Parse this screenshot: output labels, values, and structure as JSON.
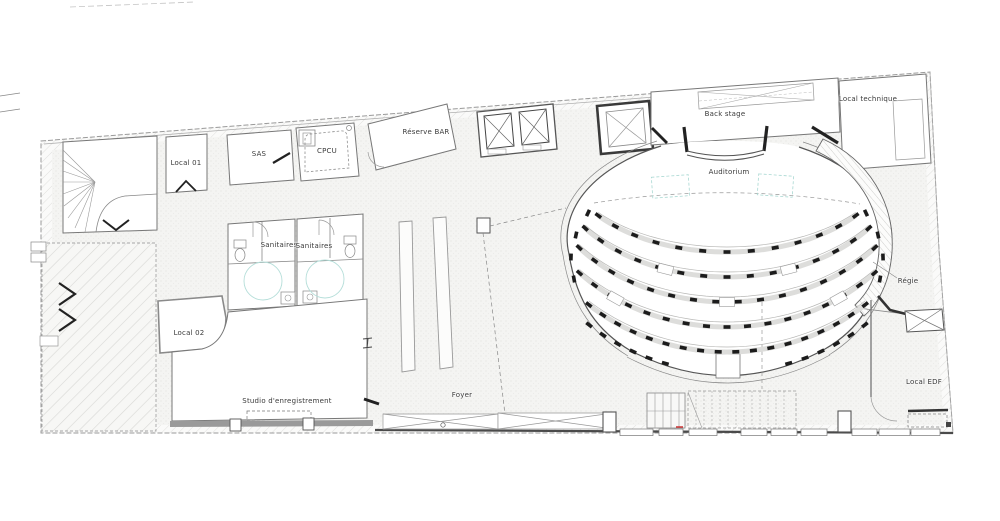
{
  "canvas": {
    "width": 1000,
    "height": 521,
    "background": "#ffffff"
  },
  "colors": {
    "line": "#777777",
    "wall": "#333333",
    "seat": "#1c1c1c",
    "boundary": "#9a9a9a",
    "cyan_accent": "#aad6d0",
    "red_mark": "#cc3333",
    "platform": "#dddddb",
    "hatch": "#dcdcdc"
  },
  "rooms": [
    {
      "id": "local-01",
      "label": "Local 01",
      "x": 186,
      "y": 163
    },
    {
      "id": "sas",
      "label": "SAS",
      "x": 259,
      "y": 154
    },
    {
      "id": "cpcu",
      "label": "CPCU",
      "x": 327,
      "y": 151
    },
    {
      "id": "reserve-bar",
      "label": "Réserve BAR",
      "x": 426,
      "y": 132
    },
    {
      "id": "back-stage",
      "label": "Back stage",
      "x": 725,
      "y": 114
    },
    {
      "id": "local-technique",
      "label": "Local technique",
      "x": 868,
      "y": 99
    },
    {
      "id": "auditorium",
      "label": "Auditorium",
      "x": 729,
      "y": 172
    },
    {
      "id": "sanitaires-1",
      "label": "Sanitaires",
      "x": 279,
      "y": 245
    },
    {
      "id": "sanitaires-2",
      "label": "Sanitaires",
      "x": 314,
      "y": 246
    },
    {
      "id": "local-02",
      "label": "Local 02",
      "x": 189,
      "y": 333
    },
    {
      "id": "studio",
      "label": "Studio d'enregistrement",
      "x": 287,
      "y": 401
    },
    {
      "id": "foyer",
      "label": "Foyer",
      "x": 462,
      "y": 395
    },
    {
      "id": "regie",
      "label": "Régie",
      "x": 908,
      "y": 281
    },
    {
      "id": "local-edf",
      "label": "Local EDF",
      "x": 924,
      "y": 382
    }
  ],
  "auditorium_seating": {
    "center": {
      "x": 727,
      "y": 150
    },
    "seat": {
      "w": 7,
      "h": 3.6
    },
    "rows": [
      {
        "rx": 168,
        "ry": 102,
        "from": 40,
        "to": 140,
        "seats": 13,
        "platform": true
      },
      {
        "rx": 180,
        "ry": 127,
        "from": 38,
        "to": 142,
        "seats": 15,
        "platform": true
      },
      {
        "rx": 193,
        "ry": 152,
        "from": 40,
        "to": 140,
        "seats": 16,
        "platform": true
      },
      {
        "rx": 205,
        "ry": 177,
        "from": 44,
        "to": 136,
        "seats": 17,
        "platform": true
      },
      {
        "rx": 215,
        "ry": 202,
        "from": 50,
        "to": 130,
        "seats": 18,
        "platform": true
      },
      {
        "rx": 224,
        "ry": 222,
        "from": 52,
        "to": 74,
        "seats": 6,
        "platform": false
      },
      {
        "rx": 224,
        "ry": 222,
        "from": 106,
        "to": 128,
        "seats": 6,
        "platform": false
      }
    ],
    "wheelchair_spots": [
      {
        "rx": 180,
        "ry": 127,
        "a": 70
      },
      {
        "rx": 180,
        "ry": 127,
        "a": 110
      },
      {
        "rx": 205,
        "ry": 177,
        "a": 57
      },
      {
        "rx": 205,
        "ry": 177,
        "a": 123
      },
      {
        "rx": 193,
        "ry": 152,
        "a": 90
      }
    ],
    "side_seats": {
      "left": [
        [
          588,
          213,
          115
        ],
        [
          576,
          235,
          102
        ],
        [
          571,
          257,
          92
        ],
        [
          574,
          279,
          80
        ]
      ],
      "right": [
        [
          866,
          213,
          65
        ],
        [
          878,
          235,
          78
        ],
        [
          883,
          257,
          88
        ],
        [
          880,
          279,
          100
        ]
      ]
    }
  }
}
